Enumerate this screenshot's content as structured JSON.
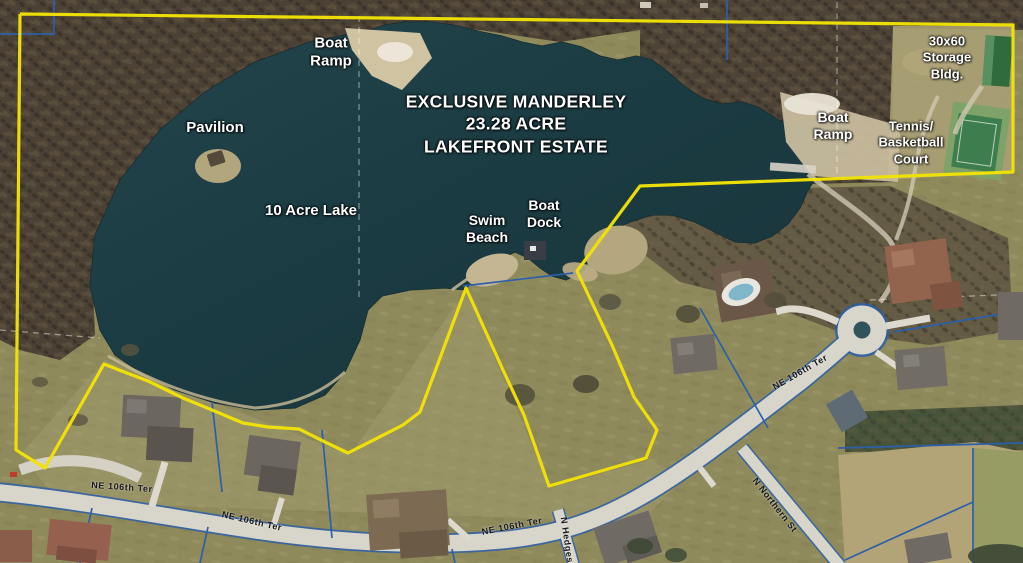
{
  "map": {
    "title": "EXCLUSIVE MANDERLEY\n23.28 ACRE\nLAKEFRONT ESTATE",
    "labels": {
      "boat_ramp_west": "Boat\nRamp",
      "pavilion": "Pavilion",
      "lake": "10 Acre Lake",
      "swim_beach": "Swim\nBeach",
      "boat_dock": "Boat\nDock",
      "boat_ramp_east": "Boat\nRamp",
      "storage_building": "30x60\nStorage\nBldg.",
      "tennis_court": "Tennis/\nBasketball\nCourt"
    },
    "streets": {
      "ne_106th_ter_a": "NE 106th Ter",
      "ne_106th_ter_b": "NE 106th Ter",
      "ne_106th_ter_c": "NE 106th Ter",
      "ne_106th_ter_d": "NE 106th Ter",
      "n_hedges": "N Hedges",
      "n_northern": "N Northern St"
    },
    "colors": {
      "boundary_yellow": "#f2e206",
      "parcel_blue": "#2d5fa8",
      "lake_teal": "#1d3e45",
      "section_line_white": "#ffffff",
      "road_gray": "#d8d5ca",
      "court_green": "#3e7d4e",
      "storage_roof_green": "#2f6b3c"
    }
  }
}
